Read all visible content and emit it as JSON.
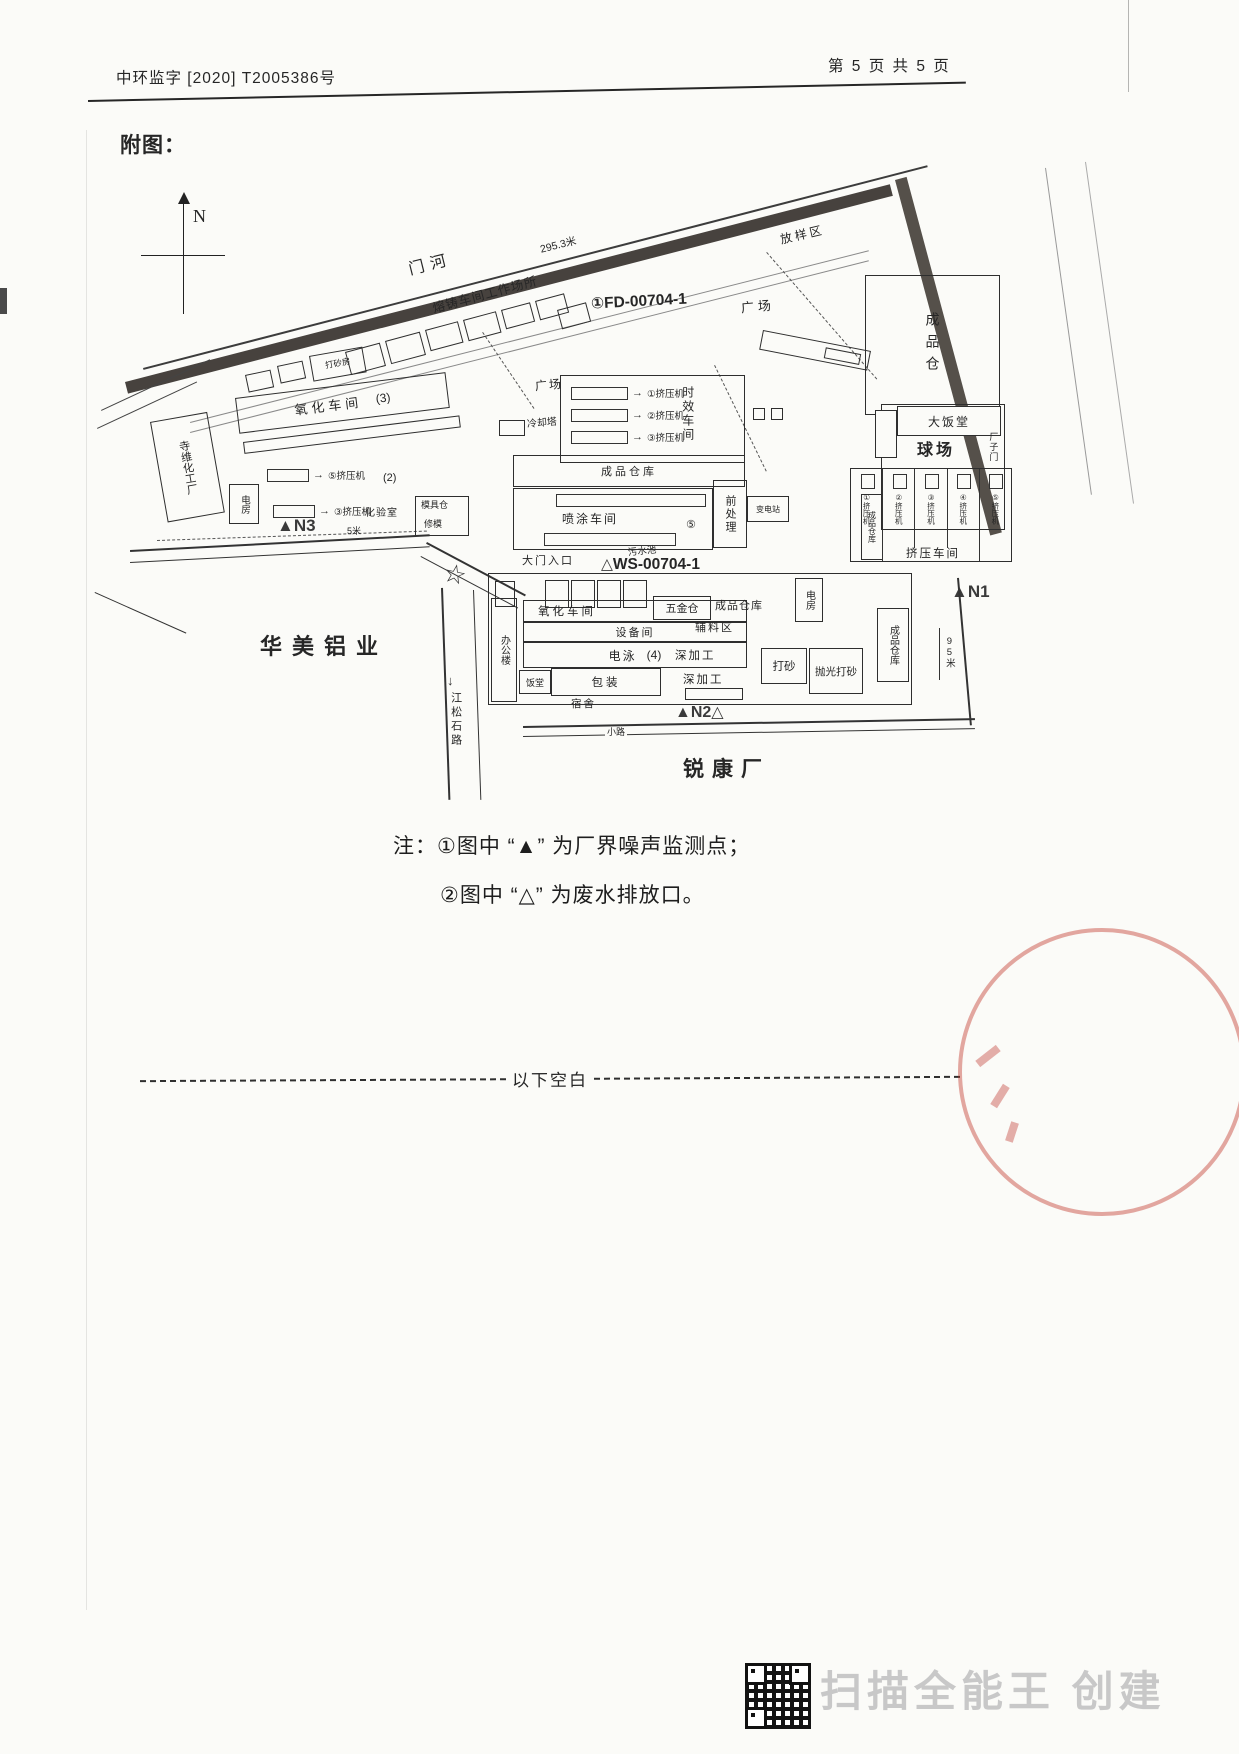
{
  "header": {
    "left": "中环监字 [2020] T2005386号",
    "right": "第 5 页 共 5 页"
  },
  "figure_label": "附图：",
  "map": {
    "compass": "N",
    "river": "门河",
    "boundary_length": "295.3米",
    "neighbors": {
      "chem_plant": "寺维化工厂",
      "west": "华美铝业",
      "south": "锐康厂"
    },
    "roads": {
      "south_road": "江松石路",
      "small_road": "小路"
    },
    "points": {
      "n1": {
        "id": "N1",
        "distance": "95米"
      },
      "n2": {
        "id": "N2"
      },
      "n3": {
        "id": "N3",
        "distance": "5米"
      }
    },
    "outfalls": {
      "fd": "①FD-00704-1",
      "ws": "WS-00704-1"
    },
    "symbols": {
      "noise": "▲",
      "outfall": "△",
      "star": "☆",
      "arrow_down": "↓",
      "arrow_right": "→"
    },
    "labels": {
      "fangyangqu": "放样区",
      "rongzhu_workshop": "熔铸车间工作场所",
      "plaza1": "广场",
      "plaza2": "广场",
      "dashafang": "打砂房",
      "finished_store_big": "成品仓",
      "canteen_big": "大饭堂",
      "court": "球场",
      "factory_gate_small": "厂子门",
      "aging_workshop": "时效车间",
      "substation": "变电站",
      "cooling_tower": "冷却塔",
      "oxidation_top": "氧化车间",
      "num3": "(3)",
      "machines_center": [
        "①挤压机",
        "②挤压机",
        "③挤压机"
      ],
      "finished_warehouse_mid": "成品仓库",
      "spray_workshop": "喷涂车间",
      "num5": "⑤",
      "pretreatment": "前处理",
      "power_room_left": "电房",
      "arrow_machines_left": [
        "⑤挤压机",
        "③挤压机"
      ],
      "num2": "(2)",
      "lab": "化验室",
      "mold_store": "模具仓",
      "mold_repair": "修模",
      "gate": "大门入口",
      "sewage_pool": "污水池",
      "office": "办公楼",
      "oxidation_bottom": "氧化车间",
      "equipment_room": "设备间",
      "electrophoresis": "电泳",
      "num4": "(4)",
      "canteen_small": "饭堂",
      "packing": "包装",
      "dorm": "宿舍",
      "hardware_store": "五金仓",
      "finished_warehouse2": "成品仓库",
      "aux_area": "辅料区",
      "deep_processing1": "深加工",
      "deep_processing2": "深加工",
      "sandblast": "打砂",
      "polish_sandblast": "抛光打砂",
      "finished_warehouse3": "成品仓库",
      "finished_warehouse4": "成品仓库",
      "power_room2": "电房",
      "extrusion_hall": "挤压车间",
      "extrusion_bays": [
        "①挤压机",
        "②挤压机",
        "③挤压机",
        "④挤压机",
        "⑤挤压机"
      ]
    }
  },
  "notes": {
    "line1": "注：①图中 “▲” 为厂界噪声监测点；",
    "line2": "②图中 “△” 为废水排放口。"
  },
  "divider_text": "以下空白",
  "footer": {
    "scanner_text": "扫描全能王 创建"
  }
}
